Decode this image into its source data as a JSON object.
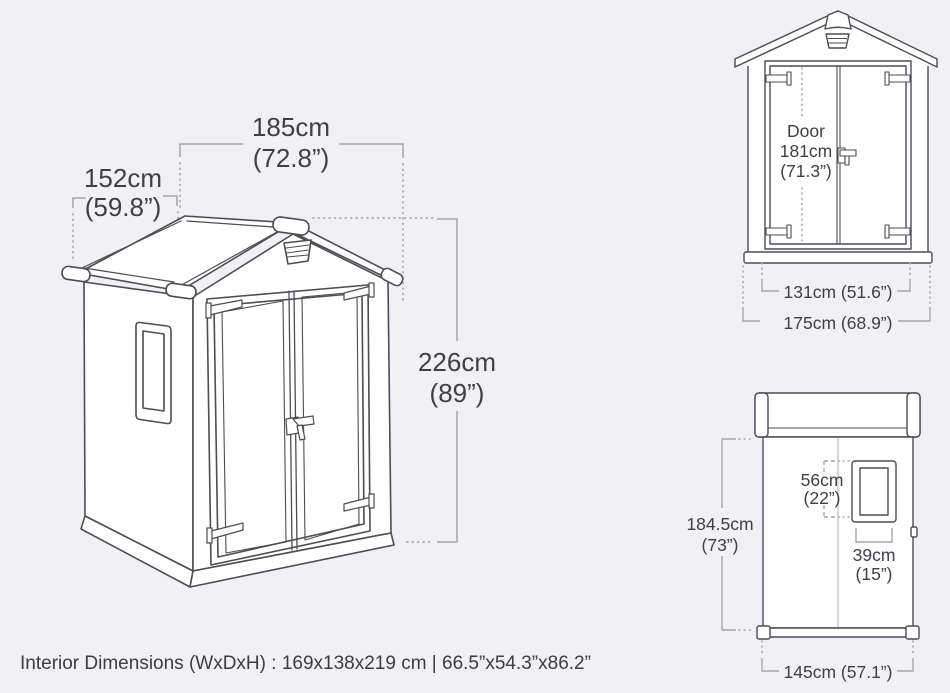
{
  "page": {
    "background": "#f1f1f5",
    "description": "Dimensional diagram of an outdoor storage shed with three views"
  },
  "colors": {
    "shed_outline": "#4d4d52",
    "dimension_line": "#a6a6ad",
    "text": "#3f3f45",
    "surface": "#ffffff"
  },
  "main_view": {
    "width": {
      "cm": "185cm",
      "inch": "(72.8”)"
    },
    "depth": {
      "cm": "152cm",
      "inch": "(59.8”)"
    },
    "height": {
      "cm": "226cm",
      "inch": "(89”)"
    }
  },
  "front_view": {
    "door": {
      "label": "Door",
      "cm": "181cm",
      "inch": "(71.3”)"
    },
    "door_width": "131cm (51.6”)",
    "overall_width": "175cm (68.9”)"
  },
  "side_view": {
    "height": {
      "cm": "184.5cm",
      "inch": "(73”)"
    },
    "window_height": {
      "cm": "56cm",
      "inch": "(22”)"
    },
    "window_width": {
      "cm": "39cm",
      "inch": "(15”)"
    },
    "overall_depth": "145cm (57.1”)"
  },
  "footer": {
    "interior_dimensions": "Interior Dimensions (WxDxH) : 169x138x219 cm | 66.5”x54.3”x86.2”"
  }
}
